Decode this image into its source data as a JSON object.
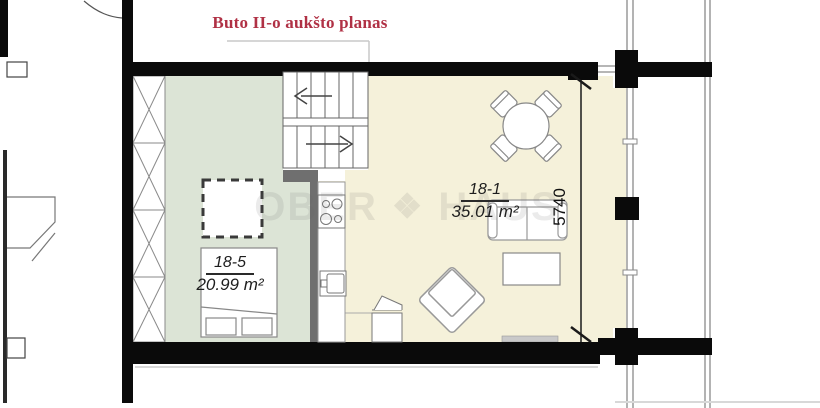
{
  "title": {
    "text": "Buto II-o aukšto planas",
    "color": "#b03145"
  },
  "rooms": [
    {
      "id": "18-1",
      "area": "35.01 m²",
      "fill": "#f5f1da"
    },
    {
      "id": "18-5",
      "area": "20.99 m²",
      "fill": "#dce4d6"
    }
  ],
  "dimension": {
    "value": "5740"
  },
  "watermark": {
    "left": "OBER",
    "logo_glyph": "❖",
    "right": "HAUS"
  },
  "colors": {
    "wall": "#0a0a0a",
    "partition_gray": "#6f6f6f",
    "line_gray": "#888888",
    "title_red": "#b03145"
  }
}
